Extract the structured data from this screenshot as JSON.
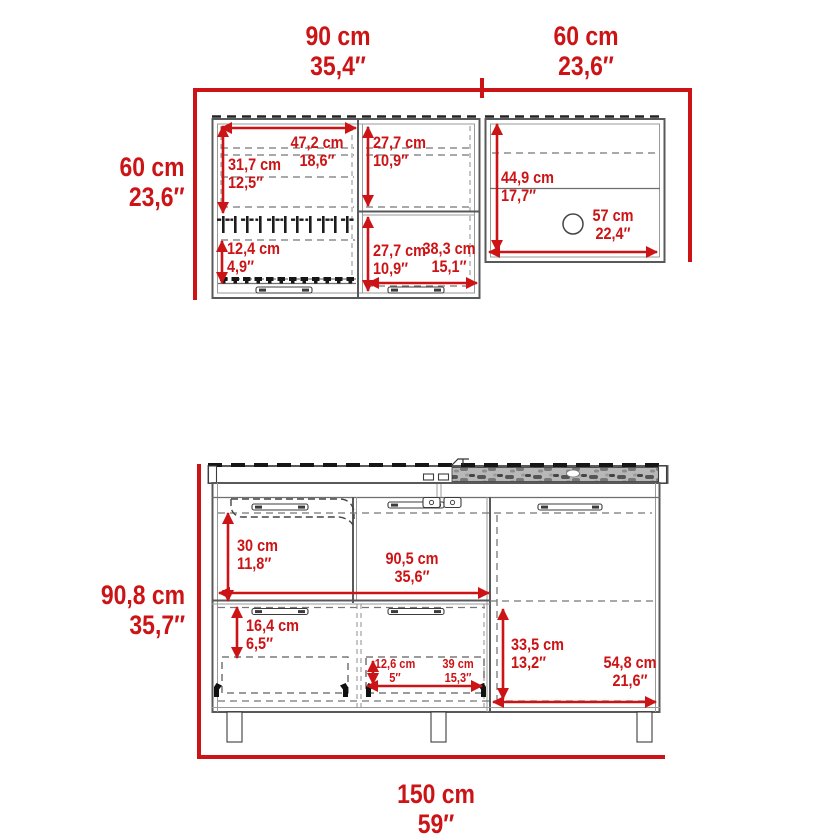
{
  "diagram_title": "cabinet-set-dimension-diagram",
  "colors": {
    "dimension_red": "#cc1416",
    "drawing_gray": "#58595b"
  },
  "top_unit": {
    "name": "wall-cabinets",
    "overall_width_left": {
      "cm": "90 cm",
      "in": "35,4″"
    },
    "overall_width_right": {
      "cm": "60 cm",
      "in": "23,6″"
    },
    "overall_height": {
      "cm": "60 cm",
      "in": "23,6″"
    },
    "left_door_width": {
      "cm": "47,2 cm",
      "in": "18,6″"
    },
    "left_upper_height": {
      "cm": "31,7 cm",
      "in": "12,5″"
    },
    "mid_upper_height": {
      "cm": "27,7 cm",
      "in": "10,9″"
    },
    "mid_lower_height": {
      "cm": "27,7 cm",
      "in": "10,9″"
    },
    "left_lower_height": {
      "cm": "12,4 cm",
      "in": "4,9″"
    },
    "mid_width": {
      "cm": "38,3 cm",
      "in": "15,1″"
    },
    "right_height": {
      "cm": "44,9 cm",
      "in": "17,7″"
    },
    "right_width": {
      "cm": "57 cm",
      "in": "22,4″"
    }
  },
  "bottom_unit": {
    "name": "base-cabinet",
    "overall_height": {
      "cm": "90,8 cm",
      "in": "35,7″"
    },
    "overall_width": {
      "cm": "150 cm",
      "in": "59″"
    },
    "upper_left_height": {
      "cm": "30 cm",
      "in": "11,8″"
    },
    "upper_width": {
      "cm": "90,5 cm",
      "in": "35,6″"
    },
    "lower_left_height": {
      "cm": "16,4 cm",
      "in": "6,5″"
    },
    "drawer_height": {
      "cm": "12,6 cm",
      "in": "5″"
    },
    "drawer_width": {
      "cm": "39 cm",
      "in": "15,3″"
    },
    "right_height": {
      "cm": "33,5 cm",
      "in": "13,2″"
    },
    "right_width": {
      "cm": "54,8 cm",
      "in": "21,6″"
    }
  }
}
